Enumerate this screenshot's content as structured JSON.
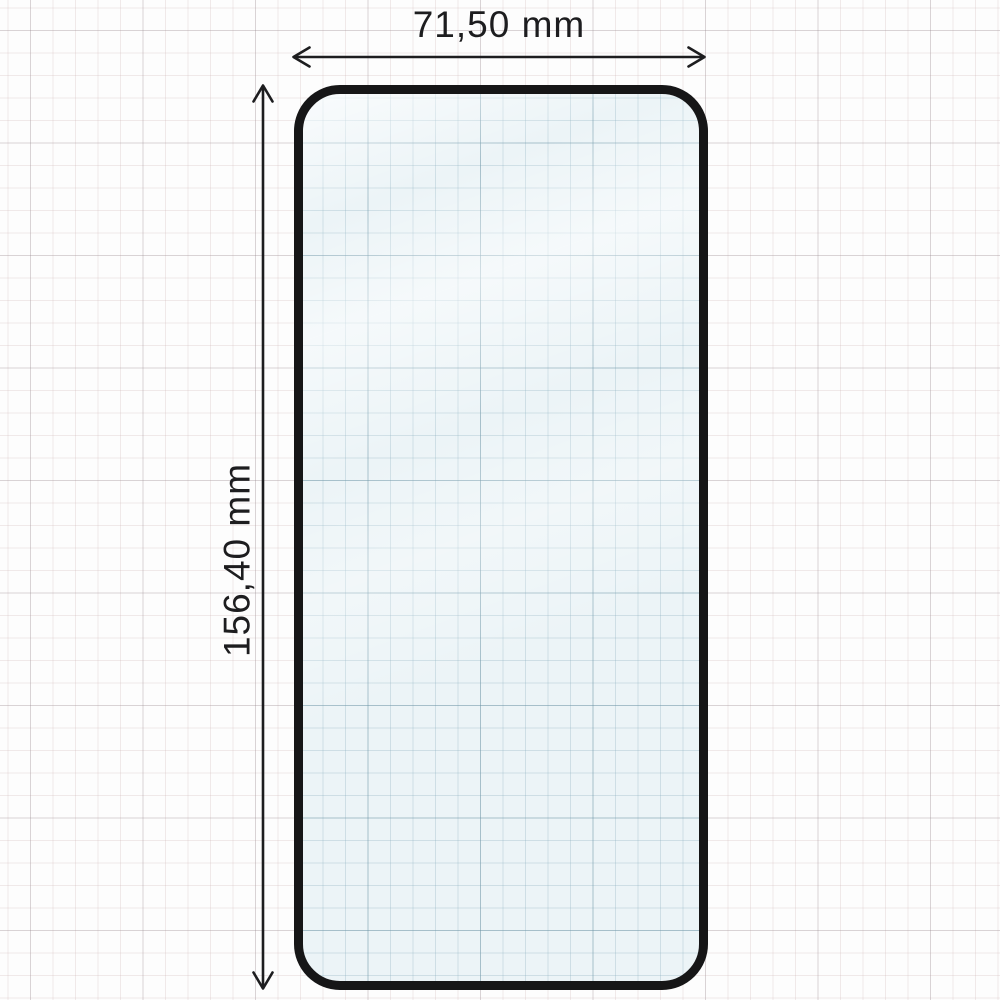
{
  "figure": {
    "type": "product-dimension-diagram",
    "product": "tempered-glass-screen-protector",
    "width_dimension": {
      "value": "71,50",
      "unit": "mm",
      "label": "71,50 mm"
    },
    "height_dimension": {
      "value": "156,40",
      "unit": "mm",
      "label": "156,40 mm"
    }
  },
  "colors": {
    "page_background": "#fdfdfd",
    "grid_minor": "#f2e9e9",
    "grid_major": "#e2e2e6",
    "glass_fill": "#ecf4f7",
    "glass_grid_minor": "#d6e4e9",
    "glass_grid_major": "#bdd2da",
    "glass_frame": "#161617",
    "dimension_ink": "#1d1d1f"
  },
  "icons": {
    "width_arrow": "horizontal-double-arrow",
    "height_arrow": "vertical-double-arrow"
  }
}
